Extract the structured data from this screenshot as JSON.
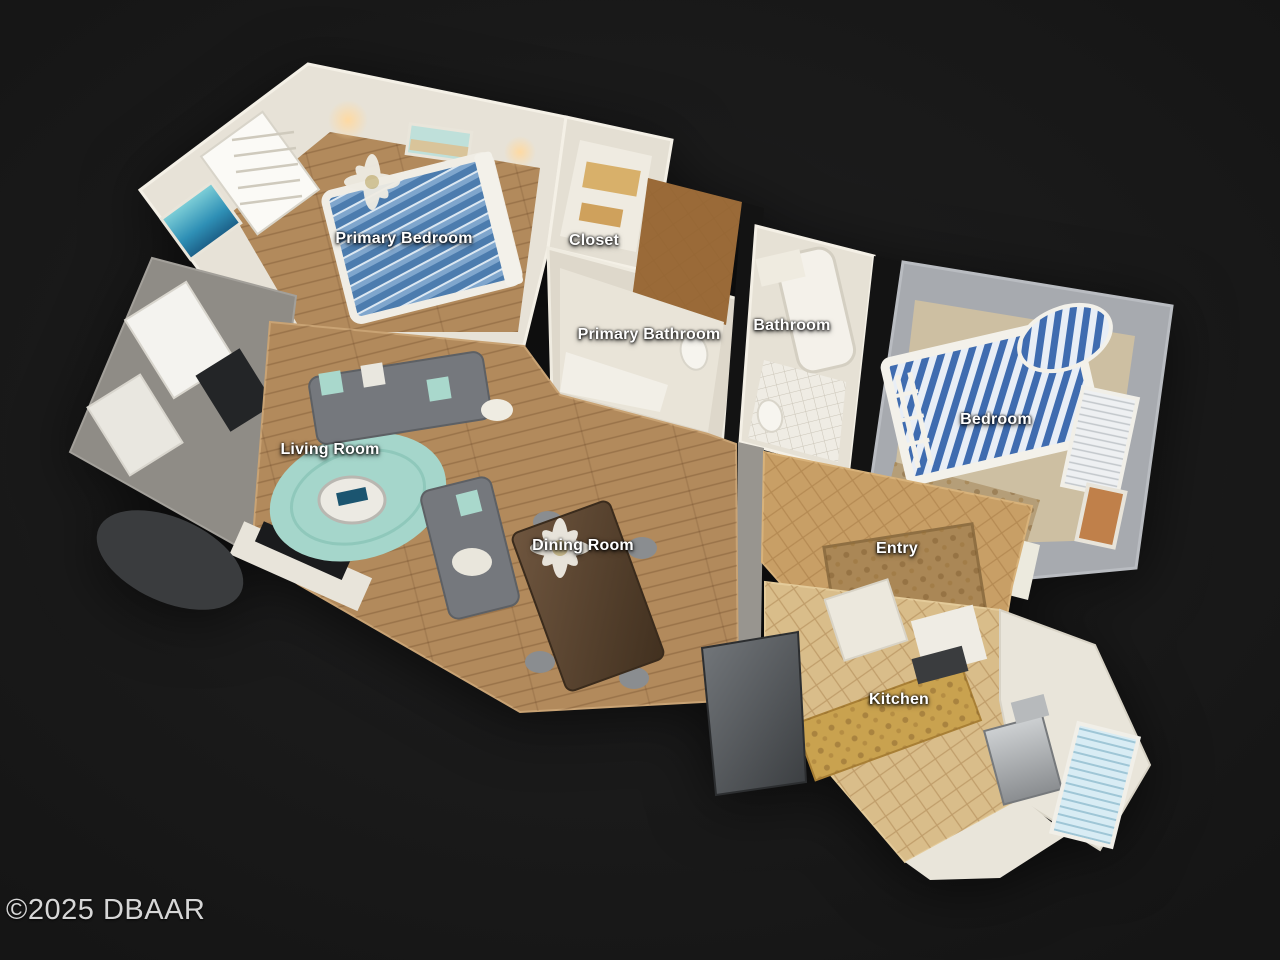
{
  "viewer": {
    "view_type": "3d-dollhouse-floorplan",
    "watermark": "©2025 DBAAR",
    "background_color": "#191919"
  },
  "rooms": [
    {
      "id": "primary-bedroom",
      "label": "Primary Bedroom"
    },
    {
      "id": "closet",
      "label": "Closet"
    },
    {
      "id": "primary-bathroom",
      "label": "Primary Bathroom"
    },
    {
      "id": "bathroom",
      "label": "Bathroom"
    },
    {
      "id": "bedroom",
      "label": "Bedroom"
    },
    {
      "id": "living-room",
      "label": "Living Room"
    },
    {
      "id": "dining-room",
      "label": "Dining Room"
    },
    {
      "id": "entry",
      "label": "Entry"
    },
    {
      "id": "kitchen",
      "label": "Kitchen"
    }
  ],
  "palette": {
    "background": "#191919",
    "label_text": "#ffffff",
    "watermark_text": "#d6d6d6",
    "wall_white": "#e7e2d7",
    "wall_gray": "#a0a3a8",
    "wood_floor": "#b28a5c",
    "tile_floor": "#c89f66",
    "rug_teal": "#a5d6cb",
    "bed_blue": "#4f7fb0",
    "sofa_gray": "#75787d"
  }
}
